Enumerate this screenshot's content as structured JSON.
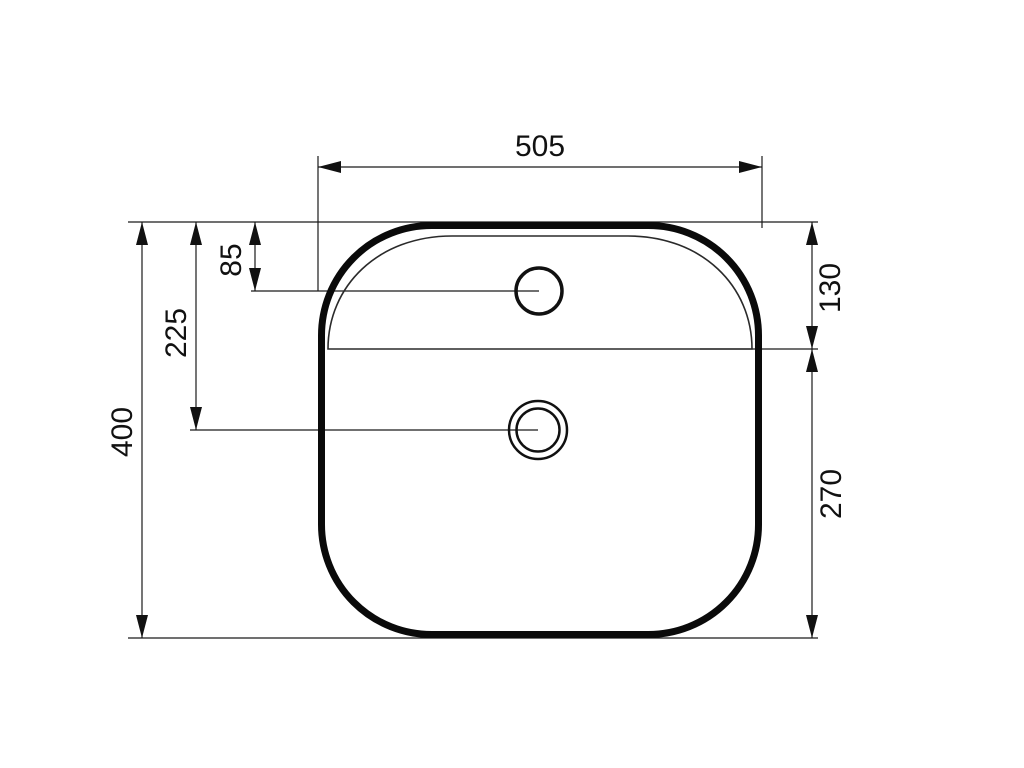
{
  "page": {
    "background": "#ffffff",
    "line_color": "#000000"
  },
  "drawing": {
    "dimensions": {
      "width": "505",
      "depth": "400",
      "tap_from_top": "85",
      "drain_from_top": "225",
      "rim_from_top": "130",
      "bottom_section": "270"
    }
  }
}
